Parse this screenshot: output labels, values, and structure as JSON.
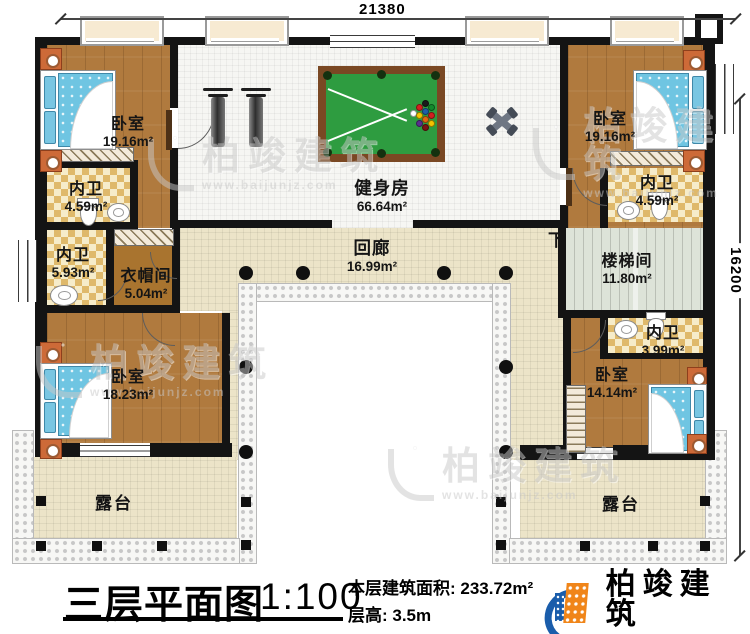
{
  "dimensions": {
    "top": "21380",
    "right": "16200"
  },
  "rooms": {
    "bedroom_tl": {
      "name": "卧室",
      "area": "19.16m²"
    },
    "bath_tl": {
      "name": "内卫",
      "area": "4.59m²"
    },
    "bath_ml": {
      "name": "内卫",
      "area": "5.93m²"
    },
    "cloakroom": {
      "name": "衣帽间",
      "area": "5.04m²"
    },
    "bedroom_bl": {
      "name": "卧室",
      "area": "18.23m²"
    },
    "gym": {
      "name": "健身房",
      "area": "66.64m²"
    },
    "corridor": {
      "name": "回廊",
      "area": "16.99m²"
    },
    "stairwell": {
      "name": "楼梯间",
      "area": "11.80m²",
      "down_label": "下"
    },
    "bedroom_tr": {
      "name": "卧室",
      "area": "19.16m²"
    },
    "bath_tr": {
      "name": "内卫",
      "area": "4.59m²"
    },
    "bath_mr": {
      "name": "内卫",
      "area": "3.99m²"
    },
    "bedroom_br": {
      "name": "卧室",
      "area": "14.14m²"
    },
    "terrace_left": {
      "name": "露台"
    },
    "terrace_right": {
      "name": "露台"
    }
  },
  "title": {
    "text": "三层平面图",
    "scale": "1:100",
    "area_line": "本层建筑面积: 233.72m²",
    "height_line": "层高: 3.5m"
  },
  "logo": {
    "name": "柏竣建筑",
    "url": "www.baijunjz.com"
  },
  "watermark": {
    "text": "柏竣建筑",
    "url": "www.baijunjz.com"
  },
  "colors": {
    "wall": "#141414",
    "wood_floor": "#b07a3e",
    "tile": "#dfb96b",
    "corridor_floor": "#ece4c8",
    "gym_floor": "#f6f6f3",
    "stair_floor": "#dde3d8",
    "pool_felt": "#2e9c40",
    "pool_frame": "#7a4823",
    "bed_blue": "#6fc5e2",
    "nightstand": "#cd6a38",
    "logo_blue": "#1a5dab",
    "logo_orange": "#f08519"
  }
}
